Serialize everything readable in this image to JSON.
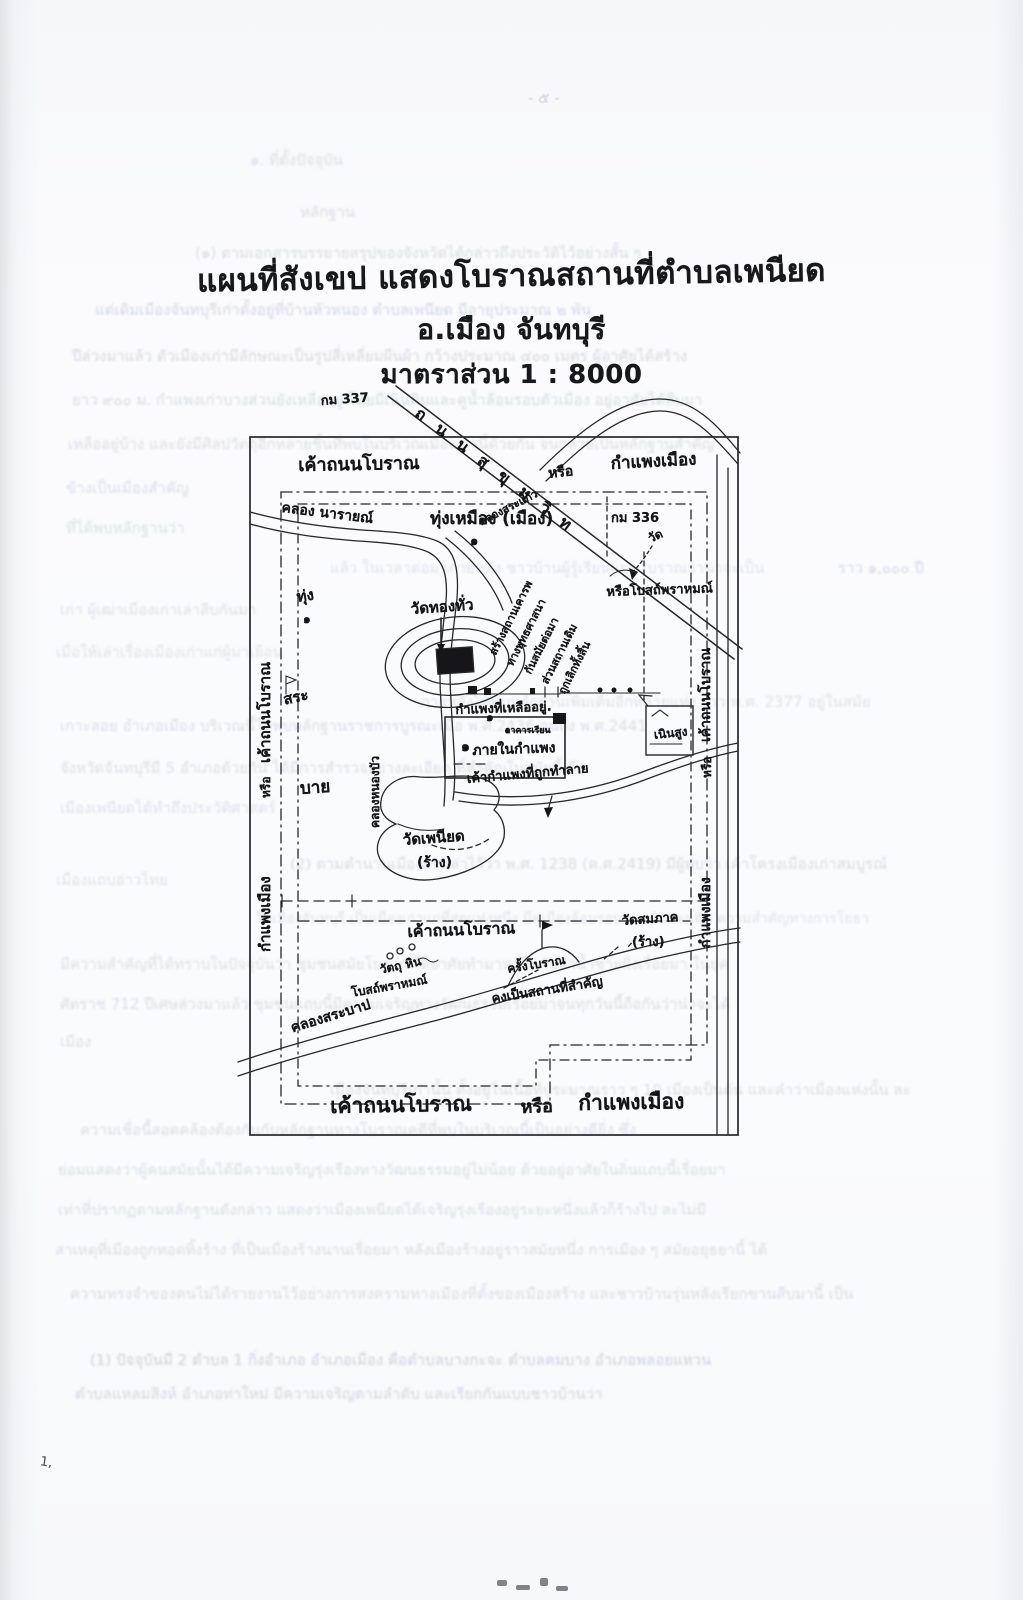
{
  "page": {
    "number_ghost": "- ๕ -",
    "pen_mark": "1,"
  },
  "title": {
    "line1": "แผนที่สังเขป แสดงโบราณสถานที่ตำบลเพนียด",
    "line2": "อ.เมือง   จันทบุรี",
    "line3": "มาตราส่วน 1 : 8000"
  },
  "map": {
    "labels": [
      {
        "name": "km-337-label",
        "text": "กม 337",
        "x": 320,
        "y": 390,
        "size": 13,
        "rot": -4
      },
      {
        "name": "sukhumvit-road-label",
        "text": "ถ น น สุ ขุ ม วิ ท",
        "x": 424,
        "y": 402,
        "size": 16,
        "rot": 37,
        "sp": 5
      },
      {
        "name": "old-road-label-top-left",
        "text": "เค้าถนนโบราณ",
        "x": 298,
        "y": 450,
        "size": 18,
        "rot": -1
      },
      {
        "name": "old-road-label-top-or",
        "text": "หรือ",
        "x": 547,
        "y": 463,
        "size": 14,
        "rot": -6
      },
      {
        "name": "old-road-label-top-right",
        "text": "กำแพงเมือง",
        "x": 610,
        "y": 450,
        "size": 17,
        "rot": -3
      },
      {
        "name": "khlong-narai-label",
        "text": "คลอง นารายณ์",
        "x": 283,
        "y": 497,
        "size": 14,
        "rot": 7
      },
      {
        "name": "km-336-label",
        "text": "กม 336",
        "x": 611,
        "y": 507,
        "size": 13,
        "rot": 0
      },
      {
        "name": "wat-marker-label",
        "text": "วัด",
        "x": 645,
        "y": 531,
        "size": 12,
        "rot": -25
      },
      {
        "name": "thung-mueang-label",
        "text": "ทุ่งเหมือง (เมือง)",
        "x": 430,
        "y": 505,
        "size": 17,
        "rot": 0
      },
      {
        "name": "marker-one-field",
        "text": "๑",
        "x": 470,
        "y": 530,
        "size": 13,
        "rot": 0
      },
      {
        "name": "khlong-sakaeo-label",
        "text": "คลองสระแก้ว",
        "x": 475,
        "y": 514,
        "size": 11,
        "rot": -27
      },
      {
        "name": "thung-label",
        "text": "ทุ่ง",
        "x": 295,
        "y": 585,
        "size": 15,
        "rot": -8
      },
      {
        "name": "marker-one-thung",
        "text": "๑",
        "x": 303,
        "y": 610,
        "size": 12,
        "rot": 0
      },
      {
        "name": "sa-label",
        "text": "สระ",
        "x": 281,
        "y": 688,
        "size": 15,
        "rot": -12
      },
      {
        "name": "bai-label",
        "text": "บาย",
        "x": 299,
        "y": 775,
        "size": 17,
        "rot": -4
      },
      {
        "name": "wat-thong-thua-label",
        "text": "วัดทองทั่ว",
        "x": 410,
        "y": 597,
        "size": 15,
        "rot": -4
      },
      {
        "name": "marker-one-moat",
        "text": "๑",
        "x": 486,
        "y": 708,
        "size": 12,
        "rot": 0
      },
      {
        "name": "note-line-1",
        "text": "สร้างสถานเคารพ",
        "x": 484,
        "y": 650,
        "size": 11,
        "rot": -63
      },
      {
        "name": "note-line-2",
        "text": "ทางพุทธศาสนา",
        "x": 501,
        "y": 661,
        "size": 11,
        "rot": -63
      },
      {
        "name": "note-line-3",
        "text": "กันสมัยต่อมา",
        "x": 519,
        "y": 669,
        "size": 11,
        "rot": -63
      },
      {
        "name": "note-line-4",
        "text": "ส่วนสถานเดิม",
        "x": 536,
        "y": 679,
        "size": 11,
        "rot": -63
      },
      {
        "name": "note-line-5",
        "text": "ถูกเลิกทั้งสิ้น",
        "x": 553,
        "y": 689,
        "size": 11,
        "rot": -63
      },
      {
        "name": "brahmin-shrine-label",
        "text": "หรือโบสถ์พราหมณ์",
        "x": 606,
        "y": 581,
        "size": 13,
        "rot": -2
      },
      {
        "name": "wall-remaining-label",
        "text": "กำแพงที่เหลืออยู่.",
        "x": 455,
        "y": 699,
        "size": 13,
        "rot": -2
      },
      {
        "name": "school-building-label",
        "text": "อาคารเรียน",
        "x": 505,
        "y": 723,
        "size": 9,
        "rot": 0
      },
      {
        "name": "marker-one-wall",
        "text": "๑",
        "x": 461,
        "y": 736,
        "size": 14,
        "rot": 0
      },
      {
        "name": "inside-wall-label",
        "text": "ภายในกำแพง",
        "x": 472,
        "y": 740,
        "size": 14,
        "rot": -2
      },
      {
        "name": "wall-demolished-label",
        "text": "เค้ากำแพงที่ถูกทำลาย",
        "x": 466,
        "y": 768,
        "size": 13,
        "rot": -5
      },
      {
        "name": "noen-sung-label",
        "text": "เนินสูง",
        "x": 653,
        "y": 726,
        "size": 12,
        "rot": -6
      },
      {
        "name": "wat-phaniat-label",
        "text": "วัดเพนียด",
        "x": 402,
        "y": 828,
        "size": 15,
        "rot": -4
      },
      {
        "name": "wat-phaniat-ruin-label",
        "text": "(ร้าง)",
        "x": 417,
        "y": 852,
        "size": 14,
        "rot": 0
      },
      {
        "name": "old-road-label-mid",
        "text": "เค้าถนนโบราณ",
        "x": 407,
        "y": 920,
        "size": 16,
        "rot": -2
      },
      {
        "name": "wat-somphak-label",
        "text": "วัดสมภาค",
        "x": 621,
        "y": 910,
        "size": 13,
        "rot": -4
      },
      {
        "name": "wat-somphak-ruin-label",
        "text": "(ร้าง)",
        "x": 632,
        "y": 931,
        "size": 13,
        "rot": 0
      },
      {
        "name": "stone-objects-label",
        "text": "วัตถุ หิน",
        "x": 378,
        "y": 961,
        "size": 12,
        "rot": -12
      },
      {
        "name": "brahmin-temple-label",
        "text": "โบสถ์พราหมณ์",
        "x": 350,
        "y": 984,
        "size": 12,
        "rot": -10
      },
      {
        "name": "ancient-times-label",
        "text": "ครั้งโบราณ",
        "x": 506,
        "y": 960,
        "size": 12,
        "rot": -9
      },
      {
        "name": "important-place-label",
        "text": "คงเป็นสถานที่สำคัญ",
        "x": 490,
        "y": 988,
        "size": 13,
        "rot": -9
      },
      {
        "name": "khlong-sabap-label",
        "text": "คลองสระบาป",
        "x": 288,
        "y": 1018,
        "size": 14,
        "rot": -17
      },
      {
        "name": "old-road-label-bottom-1",
        "text": "เค้าถนนโบราณ",
        "x": 330,
        "y": 1090,
        "size": 21,
        "rot": -1
      },
      {
        "name": "old-road-label-bottom-or",
        "text": "หรือ",
        "x": 520,
        "y": 1092,
        "size": 18,
        "rot": -2
      },
      {
        "name": "old-road-label-bottom-2",
        "text": "กำแพงเมือง",
        "x": 578,
        "y": 1087,
        "size": 21,
        "rot": -1
      },
      {
        "name": "old-road-label-left-1",
        "text": "เค้าถนนโบราณ",
        "x": 253,
        "y": 763,
        "size": 15,
        "rot": -90
      },
      {
        "name": "old-road-label-left-or",
        "text": "หรือ",
        "x": 257,
        "y": 798,
        "size": 12,
        "rot": -90
      },
      {
        "name": "old-road-label-left-2",
        "text": "กำแพงเมือง",
        "x": 253,
        "y": 952,
        "size": 15,
        "rot": -90
      },
      {
        "name": "old-road-label-right-1",
        "text": "เค้าถนนโบราณ",
        "x": 695,
        "y": 742,
        "size": 14,
        "rot": -90
      },
      {
        "name": "old-road-label-right-or",
        "text": "หรือ",
        "x": 698,
        "y": 778,
        "size": 12,
        "rot": -90
      },
      {
        "name": "old-road-label-right-2",
        "text": "กำแพงเมือง",
        "x": 695,
        "y": 948,
        "size": 14,
        "rot": -90
      },
      {
        "name": "khlong-nongbua-label",
        "text": "คลองหนองบัว",
        "x": 366,
        "y": 828,
        "size": 12,
        "rot": -90
      }
    ]
  },
  "bleedthrough": {
    "lines": [
      {
        "text": "๑. ที่ตั้งปัจจุบัน",
        "x": 250,
        "y": 148,
        "size": 15,
        "op": 0.28
      },
      {
        "text": "หลักฐาน",
        "x": 300,
        "y": 200,
        "size": 15,
        "op": 0.3
      },
      {
        "text": "(๑) ตามเอกสารบรรยายสรุปของจังหวัดได้กล่าวถึงประวัติไว้อย่างสั้น ๆ",
        "x": 195,
        "y": 241,
        "size": 15,
        "op": 0.32
      },
      {
        "text": "แต่เดิมเมืองจันทบุรีเก่าตั้งอยู่ที่บ้านหัวหนอง ตำบลเพนียด มีอายุประมาณ ๒ พัน",
        "x": 95,
        "y": 298,
        "size": 15,
        "op": 0.38
      },
      {
        "text": "ปีล่วงมาแล้ว ตัวเมืองเก่ามีลักษณะเป็นรูปสี่เหลี่ยมผืนผ้า กว้างประมาณ ๔๐๐ เมตร ผู้อาศัยได้สร้าง",
        "x": 72,
        "y": 344,
        "size": 15,
        "op": 0.36
      },
      {
        "text": "ยาว ๙๐๐ ม. กำแพงเก่าบางส่วนยังเหลืออยู่ โดยมีเนินดินและคูน้ำล้อมรอบตัวเมือง อยู่อาศัยได้สืบมา",
        "x": 72,
        "y": 388,
        "size": 15,
        "op": 0.33
      },
      {
        "text": "เหลืออยู่บ้าง และยังมีศิลปวัตถุอีกหลายชิ้นที่พบในบริเวณเมืองเก่านี้ด้วยกัน จนกลายเป็นหลักฐานสำคัญ",
        "x": 68,
        "y": 432,
        "size": 15,
        "op": 0.3
      },
      {
        "text": "ข้างเป็นเมืองสำคัญ",
        "x": 66,
        "y": 476,
        "size": 15,
        "op": 0.3
      },
      {
        "text": "ที่ได้พบหลักฐานว่า",
        "x": 66,
        "y": 516,
        "size": 15,
        "op": 0.3
      },
      {
        "text": "ราว ๑,๐๐๐ ปี",
        "x": 838,
        "y": 556,
        "size": 15,
        "op": 0.34
      },
      {
        "text": "แล้ว ในเวลาต่อมาภายหลัง ชาวบ้านผู้รู้เรียนแบบโบราณว่าน่าจะเป็น",
        "x": 330,
        "y": 556,
        "size": 15,
        "op": 0.26
      },
      {
        "text": "เก่า ผู้เฒ่าเมืองเก่าเล่าสืบกันมา",
        "x": 60,
        "y": 598,
        "size": 15,
        "op": 0.28
      },
      {
        "text": "เมื่อให้เล่าเรื่องเมืองเก่าแก่ผู้มาเยือน",
        "x": 56,
        "y": 640,
        "size": 15,
        "op": 0.26
      },
      {
        "text": "ภายหลังได้พบหลักฐานเพิ่มเติมอีกหลายแห่ง ราว พ.ศ. 2377 อยู่ในสมัย",
        "x": 420,
        "y": 690,
        "size": 15,
        "op": 0.27
      },
      {
        "text": "เกาะลอย อำเภอเมือง บริเวณนี้ได้พบหลักฐานราชการบูรณะเมื่อ พ.ศ.2436 จนถึง พ.ศ.2441",
        "x": 60,
        "y": 714,
        "size": 15,
        "op": 0.3
      },
      {
        "text": "จังหวัดจันทบุรีมี 5 อำเภอด้วยกัน ได้มีการสำรวจอย่างละเอียด ที่สำคัญในสมัยนี้ คือ",
        "x": 60,
        "y": 756,
        "size": 15,
        "op": 0.3
      },
      {
        "text": "เมืองเพนียดได้ทำถึงประวัติศาสตร์",
        "x": 60,
        "y": 796,
        "size": 15,
        "op": 0.28
      },
      {
        "text": "(2) ตามตำนานเมืองเก่าเล่าไว้ว่า พ.ศ. 1238 (ค.ศ.2419) มีผู้พบว่า เค้าโครงเมืองเก่าสมบูรณ์",
        "x": 290,
        "y": 852,
        "size": 15,
        "op": 0.33
      },
      {
        "text": "เมืองแถบอ่าวไทย",
        "x": 56,
        "y": 868,
        "size": 15,
        "op": 0.28
      },
      {
        "text": "ในเมืองจันทบุรี เป็นเมืองเก่าแก่ที่สุดแห่งหนึ่ง มีคูเมืองล้อมรอบแนวกำแพงเดิม ความสำคัญทางการโยธา",
        "x": 256,
        "y": 908,
        "size": 14,
        "op": 0.26
      },
      {
        "text": "มีความสำคัญที่ได้ทราบในปัจจุบันว่า ชุมชนสมัยโบราณได้อาศัยทำมาหากินกับลำน้ำชายฝั่งเรื่อยมา ในยุค",
        "x": 60,
        "y": 952,
        "size": 15,
        "op": 0.28
      },
      {
        "text": "ศัตราช 712 ปีเศษล่วงมาแล้ว ชุมชนแถบนี้มีความเจริญทางวัฒนธรรมเรื่อยมาจนทุกวันนี้ถือกันว่าน่าจะได้",
        "x": 60,
        "y": 992,
        "size": 15,
        "op": 0.3
      },
      {
        "text": "เมือง",
        "x": 60,
        "y": 1030,
        "size": 15,
        "op": 0.3
      },
      {
        "text": "เมืองจันทบุรีเก่านั้น ตั้งอยู่ในเนื้อที่ประมาณราว ๆ 10 เมืองเป็นต้น และคำว่าเมืองแห่งนั้น ละ",
        "x": 330,
        "y": 1078,
        "size": 15,
        "op": 0.3
      },
      {
        "text": "ความเชื่อนี้สอดคล้องต้องกันกับหลักฐานทางโบราณคดีที่พบในบริเวณนี้เป็นอย่างดียิ่ง ซึ่ง",
        "x": 80,
        "y": 1118,
        "size": 15,
        "op": 0.3
      },
      {
        "text": "ย่อมแสดงว่าผู้คนสมัยนั้นได้มีความเจริญรุ่งเรืองทางวัฒนธรรมอยู่ไม่น้อย ด้วยอยู่อาศัยในถิ่นแถบนี้เรื่อยมา",
        "x": 58,
        "y": 1158,
        "size": 15,
        "op": 0.3
      },
      {
        "text": "เท่าที่ปรากฏตามหลักฐานดังกล่าว แสดงว่าเมืองเพนียดได้เจริญรุ่งเรืองอยู่ระยะหนึ่งแล้วก็ร้างไป ละไม่มี",
        "x": 58,
        "y": 1198,
        "size": 15,
        "op": 0.3
      },
      {
        "text": "สาเหตุที่เมืองถูกทอดทิ้งร้าง ที่เป็นเมืองร้างนานเรื่อยมา หลังเมืองร้างอยู่ราวสมัยหนึ่ง การเมือง ๆ สมัยอยุธยานี้ ได้",
        "x": 55,
        "y": 1238,
        "size": 15,
        "op": 0.3
      },
      {
        "text": "ความทรงจำของคนไม่ได้รายงานไว้อย่างการสงครามทางเมืองที่ตั้งของเมืองสร้าง และชาวบ้านรุ่นหลังเรียกขานสืบมานี้ เป็น",
        "x": 70,
        "y": 1282,
        "size": 15,
        "op": 0.3
      },
      {
        "text": "(1) ปัจจุบันมี 2 ตำบล 1 กิ่งอำเภอ อำเภอเมือง คือตำบลบางกะจะ ตำบลคมบาง อำเภอพลอยแหวน",
        "x": 90,
        "y": 1348,
        "size": 15,
        "op": 0.42
      },
      {
        "text": "ตำบลแหลมสิงห์ อำเภอท่าใหม่ มีความเจริญตามลำดับ และเรียกกันแบบชาวบ้านว่า",
        "x": 75,
        "y": 1382,
        "size": 15,
        "op": 0.36
      }
    ]
  }
}
